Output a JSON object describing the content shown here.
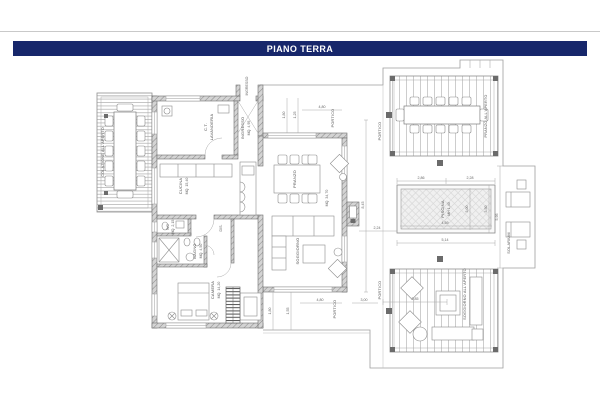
{
  "window": {
    "title": "PIANO TERRA"
  },
  "colors": {
    "header_bg": "#17276b",
    "header_text": "#ffffff",
    "wall_gray": "#d6d6d6",
    "line_gray": "#9a9a9a"
  },
  "rooms": {
    "ct_line1": "C.T.",
    "ct_line2": "LAVANDERIA",
    "cucina": "CUCINA",
    "cucina_mq": "MQ. 15,40",
    "ingresso": "INGRESSO",
    "ingresso_mq": "MQ. 4,95",
    "pranzo": "PRANZO",
    "sala_mq": "MQ. 34,70",
    "soggiorno": "SOGGIORNO",
    "wc": "WC",
    "wc_mq": "MQ. 2,15",
    "bagno": "BAGNO",
    "bagno_mq": "MQ. 4,50",
    "dis": "DIS.",
    "camera": "CAMERA",
    "camera_mq": "MQ. 14,20"
  },
  "outdoor": {
    "colazione": "COLAZIONE ALL'APERTO",
    "pranzo_aperto": "PRANZO ALL'APERTO",
    "soggiorno_aperto": "SOGGIORNO ALL'APERTO",
    "piscina": "PISCINA",
    "piscina_h": "MH 1,40",
    "solarium": "SOLARIUM",
    "portico": "PORTICO"
  },
  "dimensions": {
    "house_height": "8,45",
    "wall_pool_gap": "2,24",
    "pool_top_left": "2,86",
    "pool_top_right": "2,28",
    "pool_inner_w": "4,59",
    "pool_outer_w": "5,14",
    "pool_inner_h": "3,00",
    "pool_outer_h": "3,50",
    "terrace_h": "5,95",
    "portico_w": "4,80",
    "portico_d1": "1,55",
    "portico_d2": "1,80",
    "portico_d3": "1,25",
    "portico_s": "3,00",
    "pergola_w": "2,85"
  }
}
